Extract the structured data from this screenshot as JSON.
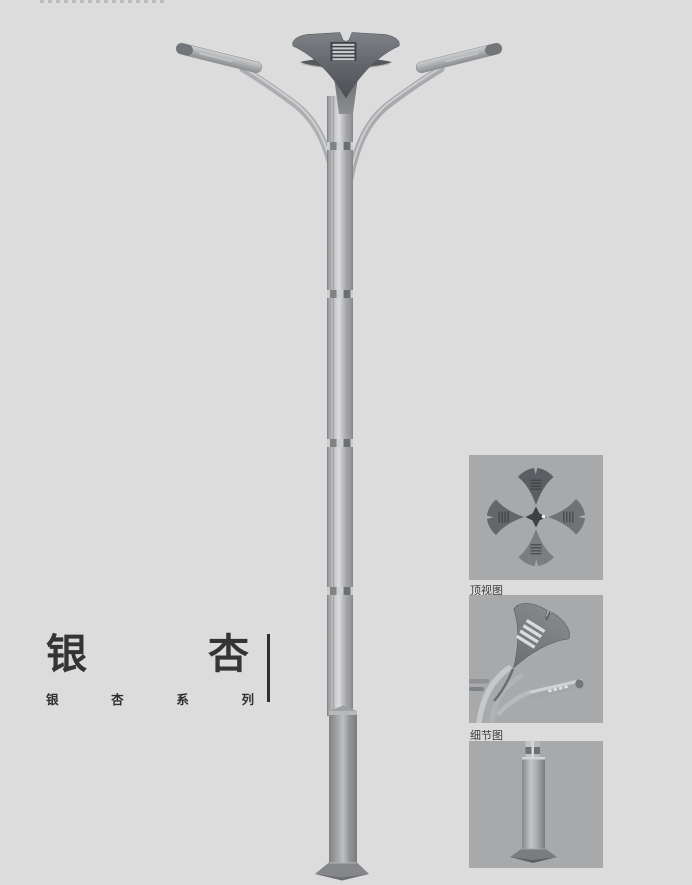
{
  "page": {
    "background_color": "#dcdcdd",
    "thumbnail_background_color": "#a8a9ab",
    "title_text_color": "#343434",
    "metal_dark_color": "#5f6266",
    "metal_light_color": "#c5c6c8"
  },
  "title": {
    "main_text": "银杏",
    "main_characters": [
      "银",
      "杏"
    ],
    "series_text": "银杏系列",
    "series_characters": [
      "银",
      "杏",
      "系",
      "列"
    ]
  },
  "views": [
    {
      "name": "top-view",
      "label": "顶视图"
    },
    {
      "name": "detail-view",
      "label": "细节图"
    },
    {
      "name": "base-view",
      "label": ""
    }
  ]
}
